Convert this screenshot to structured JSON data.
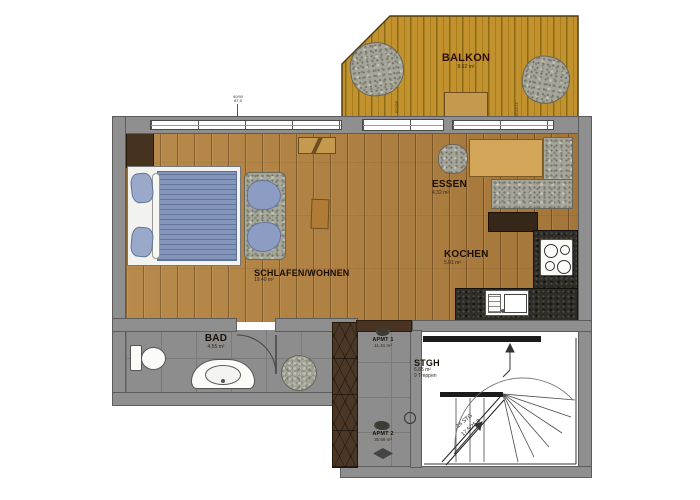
{
  "rooms": {
    "balkon": {
      "name": "BALKON",
      "area": "8.62 m²"
    },
    "essen": {
      "name": "ESSEN",
      "area": "4.32 m²"
    },
    "kochen": {
      "name": "KOCHEN",
      "area": "5.01 m²"
    },
    "schlafen_wohnen": {
      "name": "SCHLAFEN/WOHNEN",
      "area": "19.40 m²"
    },
    "bad": {
      "name": "BAD",
      "area": "4.55 m²"
    },
    "stgh": {
      "name": "STGH",
      "area": "6.85 m²",
      "note": "9 Treppen"
    }
  },
  "corridor": {
    "apmt1": {
      "name": "APMT 1",
      "area": "11.41 m²"
    },
    "apmt2": {
      "name": "APMT 2",
      "area": "30.69 m²"
    }
  },
  "stairs": {
    "note1": "16 STG",
    "note2": "17,5/25,8"
  },
  "dimensions": {
    "top_window_a": "90/90",
    "top_window_b": "87,5",
    "balcony_door": "86/216",
    "right_window": "123/216"
  },
  "colors": {
    "wood_floor": "#b08040",
    "balcony_wood": "#c2922f",
    "wall_gray": "#8f8f8f",
    "tile_gray": "#8d8d8d",
    "counter_granite": "#2f2d28",
    "furniture_blue": "#8d9cc2",
    "pebble_gray": "#a5a59a"
  }
}
